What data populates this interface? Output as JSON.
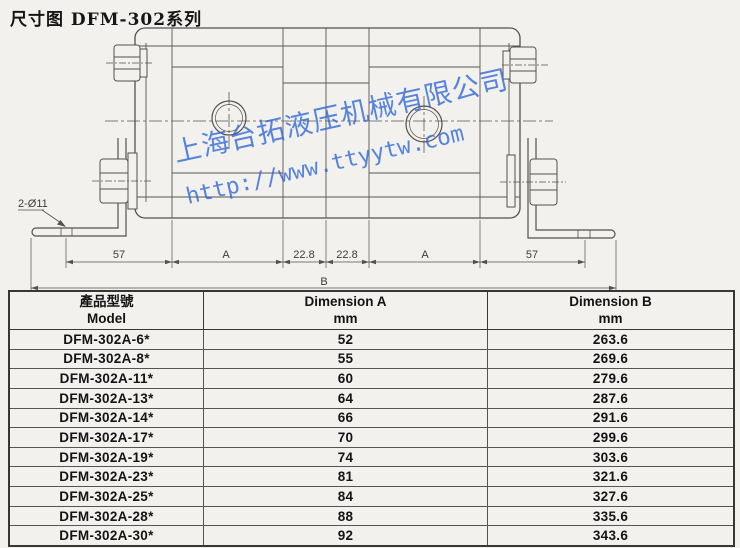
{
  "title": "尺寸图 DFM-302系列",
  "watermark": {
    "line1": "上海台拓液压机械有限公司",
    "line2": "http://www.ttyytw.com",
    "color": "#2e68d8"
  },
  "drawing": {
    "hole_callout": "2-Ø11",
    "dim_labels": {
      "left_57": "57",
      "left_A": "A",
      "left_228": "22.8",
      "right_228": "22.8",
      "right_A": "A",
      "right_57": "57",
      "overall_B": "B"
    }
  },
  "table": {
    "headers": {
      "model_zh": "產品型號",
      "model_en": "Model",
      "dim_a_title": "Dimension A",
      "dim_a_unit": "mm",
      "dim_b_title": "Dimension B",
      "dim_b_unit": "mm"
    },
    "rows": [
      {
        "model": "DFM-302A-6*",
        "a": "52",
        "b": "263.6"
      },
      {
        "model": "DFM-302A-8*",
        "a": "55",
        "b": "269.6"
      },
      {
        "model": "DFM-302A-11*",
        "a": "60",
        "b": "279.6"
      },
      {
        "model": "DFM-302A-13*",
        "a": "64",
        "b": "287.6"
      },
      {
        "model": "DFM-302A-14*",
        "a": "66",
        "b": "291.6"
      },
      {
        "model": "DFM-302A-17*",
        "a": "70",
        "b": "299.6"
      },
      {
        "model": "DFM-302A-19*",
        "a": "74",
        "b": "303.6"
      },
      {
        "model": "DFM-302A-23*",
        "a": "81",
        "b": "321.6"
      },
      {
        "model": "DFM-302A-25*",
        "a": "84",
        "b": "327.6"
      },
      {
        "model": "DFM-302A-28*",
        "a": "88",
        "b": "335.6"
      },
      {
        "model": "DFM-302A-30*",
        "a": "92",
        "b": "343.6"
      }
    ]
  }
}
